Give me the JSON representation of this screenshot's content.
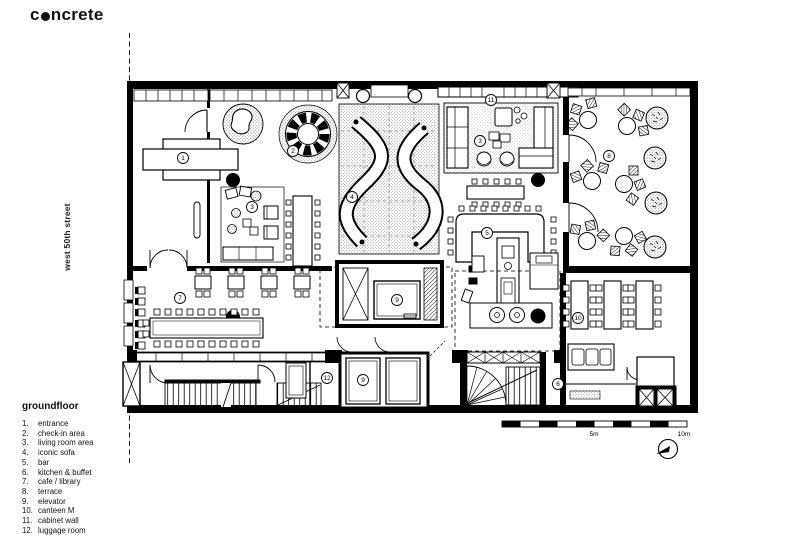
{
  "logo": {
    "prefix": "c",
    "suffix": "ncrete"
  },
  "street_label": "west 50th street",
  "legend": {
    "title": "groundfloor",
    "items": [
      {
        "num": "1.",
        "label": "entrance"
      },
      {
        "num": "2.",
        "label": "check-in area"
      },
      {
        "num": "3.",
        "label": "living room area"
      },
      {
        "num": "4.",
        "label": "iconic sofa"
      },
      {
        "num": "5.",
        "label": "bar"
      },
      {
        "num": "6.",
        "label": "kitchen & buffet"
      },
      {
        "num": "7.",
        "label": "cafe / library"
      },
      {
        "num": "8.",
        "label": "terrace"
      },
      {
        "num": "9.",
        "label": "elevator"
      },
      {
        "num": "10.",
        "label": "canteen M"
      },
      {
        "num": "11.",
        "label": "cabinet wall"
      },
      {
        "num": "12.",
        "label": "luggage room"
      }
    ]
  },
  "plan": {
    "markers": [
      "1",
      "2",
      "3",
      "3",
      "4",
      "5",
      "6",
      "7",
      "8",
      "9",
      "9",
      "10",
      "11",
      "12"
    ]
  },
  "scale": {
    "mid_label": "5m",
    "end_label": "10m"
  },
  "colors": {
    "ink": "#000000",
    "paper": "#ffffff"
  }
}
